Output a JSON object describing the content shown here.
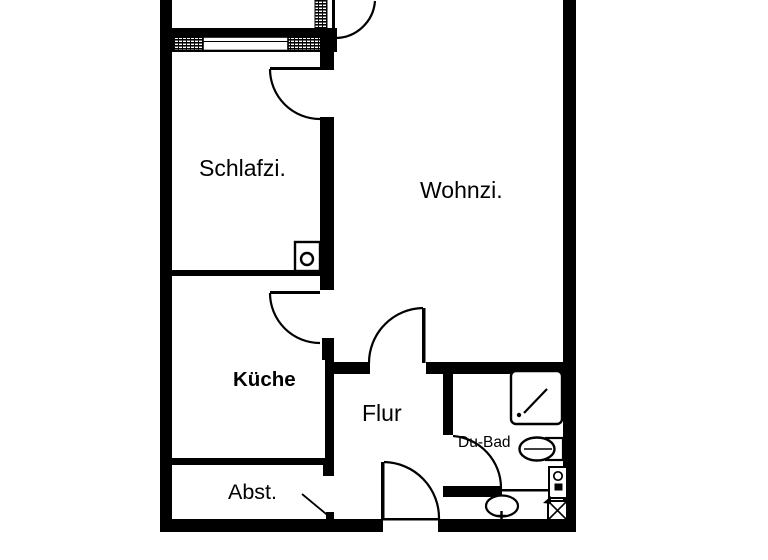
{
  "floorplan": {
    "background": "#ffffff",
    "wall_color": "#000000",
    "rooms": [
      {
        "id": "schlafzimmer",
        "label": "Schlafzi."
      },
      {
        "id": "wohnzimmer",
        "label": "Wohnzi."
      },
      {
        "id": "kueche",
        "label": "Küche"
      },
      {
        "id": "flur",
        "label": "Flur"
      },
      {
        "id": "du-bad",
        "label": "Du-Bad"
      },
      {
        "id": "abstellraum",
        "label": "Abst."
      }
    ],
    "icons": {
      "shower": "square with diagonal line and drain dot",
      "toilet": "oval bowl with cistern box",
      "washbasin": "oval basin with tap cross",
      "washing_machine": "box with porthole circle and detergent square",
      "installation_shaft": "box with X cross and arrow",
      "chimney": "box with circle"
    }
  }
}
